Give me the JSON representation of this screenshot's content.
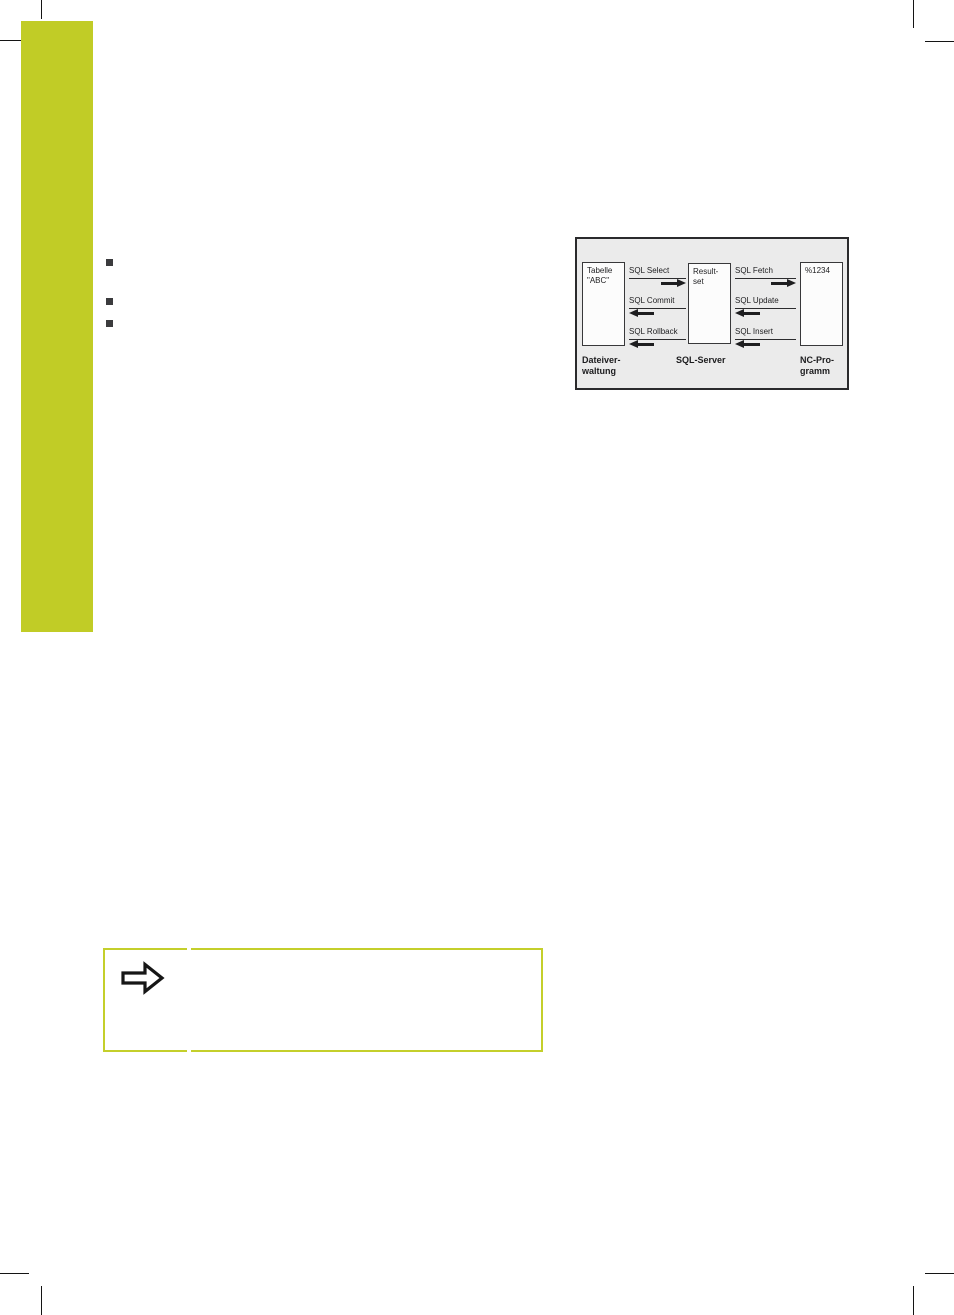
{
  "page": {
    "background": "#ffffff",
    "crop_mark_color": "#141414"
  },
  "sidebar_tab": {
    "color": "#c1cc26"
  },
  "bullets": {
    "count": 3,
    "color": "#3b3b3d"
  },
  "diagram": {
    "colors": {
      "background": "#ebebeb",
      "border": "#2a2a2c"
    },
    "nodes": {
      "tabelle": {
        "line1": "Tabelle",
        "line2": "\"ABC\""
      },
      "resultset": {
        "line1": "Result-",
        "line2": "set"
      },
      "ncprog": {
        "line1": "%1234"
      }
    },
    "arrows": {
      "select": {
        "label": "SQL Select",
        "direction": "right"
      },
      "commit": {
        "label": "SQL Commit",
        "direction": "left"
      },
      "rollback": {
        "label": "SQL Rollback",
        "direction": "left"
      },
      "fetch": {
        "label": "SQL Fetch",
        "direction": "right"
      },
      "update": {
        "label": "SQL Update",
        "direction": "left"
      },
      "insert": {
        "label": "SQL Insert",
        "direction": "left"
      }
    },
    "captions": {
      "left": {
        "line1": "Dateiver-",
        "line2": "waltung"
      },
      "center": {
        "line1": "SQL-Server"
      },
      "right": {
        "line1": "NC-Pro-",
        "line2": "gramm"
      }
    }
  },
  "note_box": {
    "border_color": "#c4cf2b",
    "icon": "note-arrow-icon"
  }
}
